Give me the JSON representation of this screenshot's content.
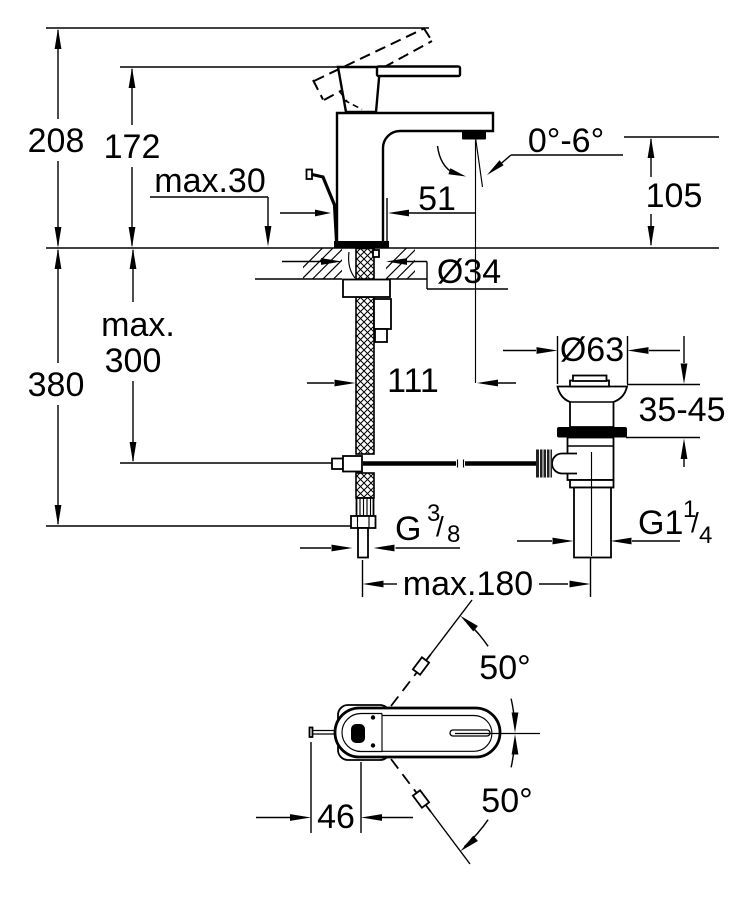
{
  "drawing": {
    "type": "technical-dimension-drawing",
    "subject": "single-lever basin mixer faucet with pop-up waste set",
    "views": [
      "front-elevation",
      "top-plan"
    ],
    "line_color": "#000000",
    "background": "#ffffff"
  },
  "dimensions": {
    "total_height": "208",
    "lever_height": "172",
    "deck_thickness_max": "max.30",
    "spout_angle_range": "0°-6°",
    "spout_outlet_height": "105",
    "spout_tip_offset": "51",
    "mounting_hole_diameter": "Ø34",
    "hose_length_max_line1": "max.",
    "hose_length_max_line2": "300",
    "total_depth": "380",
    "spout_to_waste_offset": "111",
    "waste_flange_diameter": "Ø63",
    "basin_thickness_range": "35-45",
    "supply_thread_g": "G",
    "supply_thread_sup": "3",
    "supply_thread_slash": "/",
    "supply_thread_sub": "8",
    "waste_thread_g": "G1",
    "waste_thread_sup": "1",
    "waste_thread_slash": "/",
    "waste_thread_sub": "4",
    "rod_length_max": "max.180",
    "swivel_angle_upper": "50°",
    "swivel_angle_lower": "50°",
    "rod_offset": "46"
  }
}
